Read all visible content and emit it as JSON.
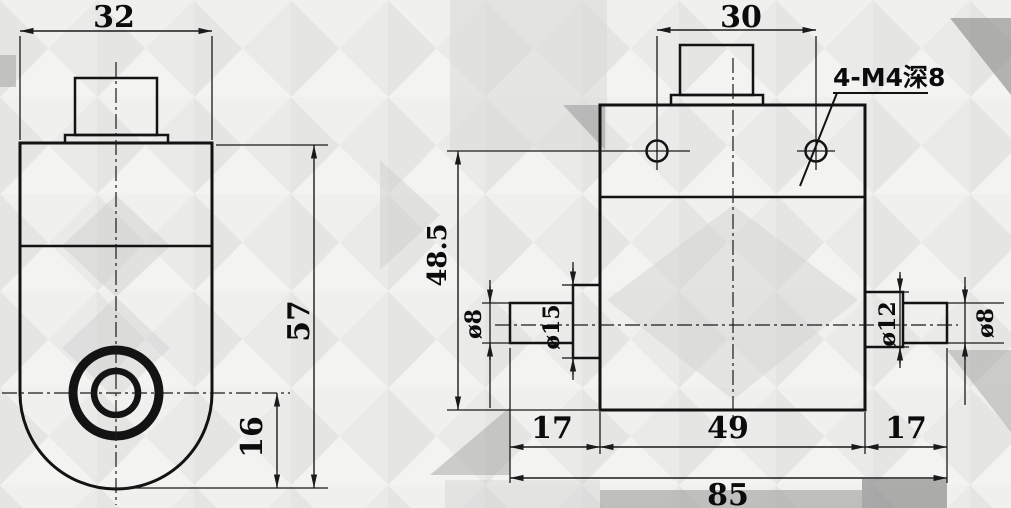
{
  "colors": {
    "line": "#131313",
    "text": "#0c0c0c",
    "background": "#f7f7f5"
  },
  "side_view": {
    "width": "32",
    "height": "57",
    "center_to_bottom": "16"
  },
  "front_view": {
    "hole_spacing": "30",
    "hole_height": "48.5",
    "thread_note": "4-M4深8",
    "shaft_left_dia": "ø8",
    "collar_left_dia": "ø15",
    "collar_right_dia": "ø12",
    "shaft_right_dia": "ø8",
    "shaft_left_len": "17",
    "body_len": "49",
    "shaft_right_len": "17",
    "total_len": "85"
  }
}
